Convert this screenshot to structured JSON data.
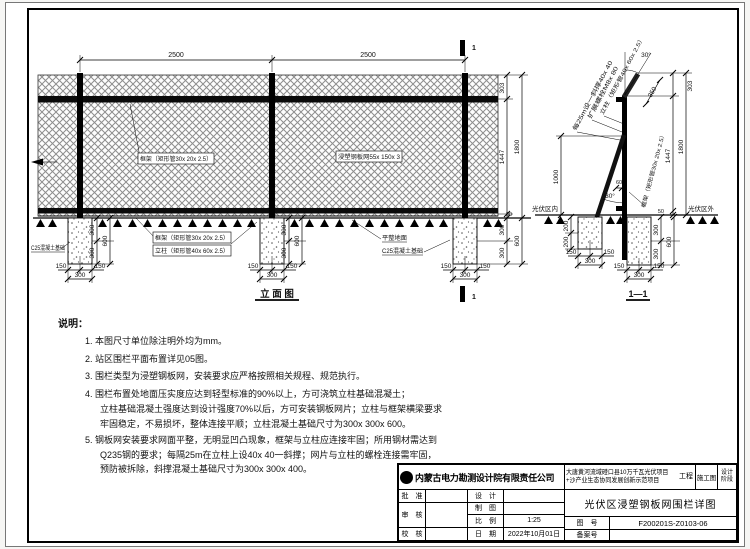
{
  "views": {
    "elevation_title": "立 面 图",
    "section_title": "1—1",
    "section_mark": "1"
  },
  "dims": {
    "span": "2500",
    "top_h": "303",
    "mesh_h": "1447",
    "total_h": "1800",
    "ground_gap": "50",
    "found_half_w": "150",
    "found_w": "300",
    "found_half_d": "300",
    "found_d": "600",
    "brace_found_half_d": "200",
    "brace_h": "1000",
    "brace_offset": "60",
    "angle": "30°",
    "arm_len": "350"
  },
  "labels": {
    "frame_top": "框架（矩形管30x 20x 2.5）",
    "mesh": "浸塑钢板网55x 150x 3",
    "c25_left": "C25混凝土基础",
    "frame_bottom": "框架（矩形管30x 20x 2.5）",
    "post": "立柱（矩形管40x 60x 2.5）",
    "level_ground": "平整地面",
    "c25_right": "C25混凝土基础",
    "brace_note": "每25m设一斜撑40x 40",
    "bolt": "扩展螺栓M8x 80",
    "section_post": "立柱（矩形管40x 60x 2.5）",
    "section_frame": "框架（矩形管30x 20x 2.5）",
    "inside": "光伏区内",
    "outside": "光伏区外"
  },
  "notes": {
    "heading": "说明：",
    "lines": [
      "1. 本图尺寸单位除注明外均为mm。",
      "2. 站区围栏平面布置详见05图。",
      "3. 围栏类型为浸塑钢板网，安装要求应严格按照相关规程、规范执行。",
      "4. 围栏布置处地面压实度应达到轻型标准的90%以上，方可浇筑立柱基础混凝土；",
      "立柱基础混凝土强度达到设计强度70%以后，方可安装钢板网片；立柱与框架横梁要求",
      "牢固稳定，不易损坏，整体连接平顺；立柱混凝土基础尺寸为300x 300x 600。",
      "5. 钢板网安装要求网面平整，无明显凹凸现象，框架与立柱应连接牢固；所用钢材需达到",
      "Q235钢的要求；每隔25m在立柱上设40x 40一斜撑；网片与立柱的螺栓连接需牢固，",
      "预防被拆除，斜撑混凝土基础尺寸为300x 300x 400。"
    ]
  },
  "titleblock": {
    "company": "内蒙古电力勘测设计院有限责任公司",
    "project_line1": "大唐黄河流域磴口县10万千瓦光伏项目",
    "project_line2": "+沙产业生态协同发展创新示范项目",
    "project_suffix": "工程",
    "stage_value": "施工图",
    "stage_label1": "设计",
    "stage_label2": "阶段",
    "drawing_title": "光伏区浸塑钢板网围栏详图",
    "rows": {
      "approve": "批　准",
      "design": "设　计",
      "review": "审　核",
      "draft": "制　图",
      "scale_label": "比　例",
      "scale": "1:25",
      "check": "校　核",
      "date_label": "日　期",
      "date": "2022年10月01日",
      "figno_label": "图　号",
      "figno": "F200201S-Z0103-06",
      "record_label": "备案号"
    }
  }
}
